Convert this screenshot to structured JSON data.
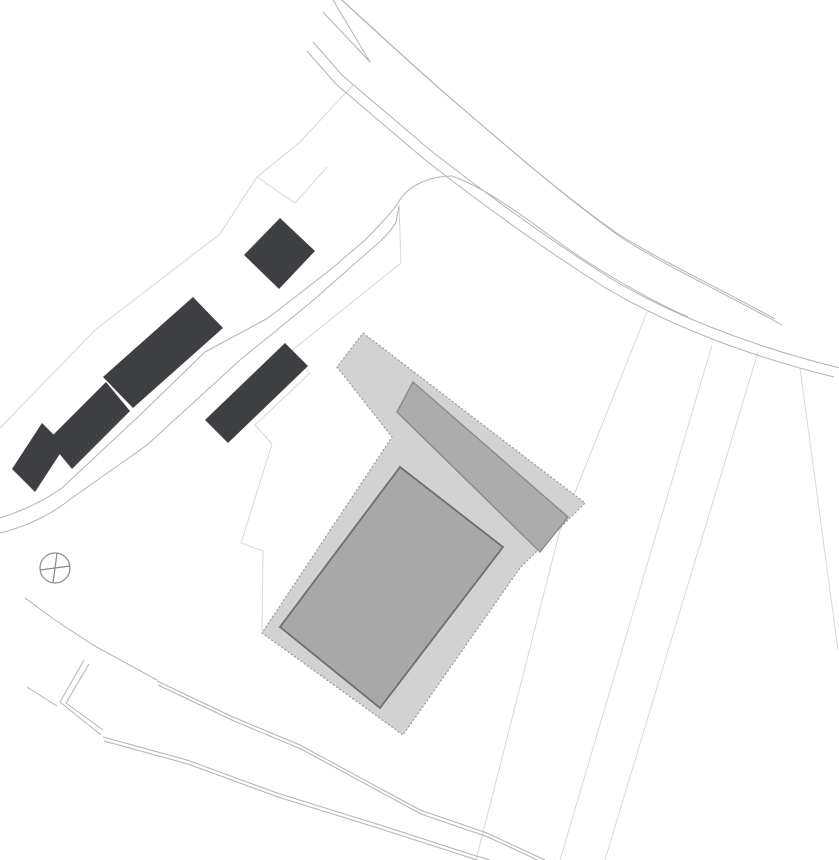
{
  "canvas": {
    "width": 839,
    "height": 860,
    "background": "#ffffff"
  },
  "palette": {
    "existing_building_fill": "#3d3f42",
    "platform_fill": "#d2d2d2",
    "platform_edge": "#9a9aa0",
    "wing_fill": "#acacac",
    "wing_edge": "#8a8a8a",
    "main_building_fill": "#a8a8a8",
    "main_building_edge": "#6f6f6f",
    "road_line": "#b3b3b8",
    "faint_line": "#d7d7db",
    "marker_line": "#8a8a8a"
  },
  "site": {
    "platform": {
      "name": "proposed-site-platform",
      "points": "363,333 585,503 520,568 403,735 262,633 392,437 337,367",
      "fill": "#d2d2d2",
      "stroke": "#9a9aa0",
      "stroke_width": 1.2,
      "dash": "2 2"
    },
    "wing": {
      "name": "proposed-building-wing",
      "points": "413,382 568,517 540,552 397,412",
      "fill": "#acacac",
      "stroke": "#8a8a8a",
      "stroke_width": 1.4
    },
    "main_building": {
      "name": "proposed-main-building",
      "points": "400,467 503,547 380,708 280,627",
      "fill": "#a8a8a8",
      "stroke": "#6f6f6f",
      "stroke_width": 1.8
    }
  },
  "existing_buildings": [
    {
      "name": "existing-building-north",
      "points": "244,255 280,218 315,251 279,289"
    },
    {
      "name": "existing-building-row-upper",
      "points": "193,297 223,328 133,408 103,377"
    },
    {
      "name": "existing-building-row-middle",
      "points": "106,382 130,411 72,469 48,440"
    },
    {
      "name": "existing-building-row-lower",
      "points": "42,423 65,446 35,492 12,469"
    },
    {
      "name": "existing-building-small-east",
      "points": "285,343 308,366 228,443 205,420"
    }
  ],
  "roads": [
    {
      "name": "main-road-north-edge",
      "d": "M342,0 C375,30 420,72 462,108 C520,158 575,205 625,240 C670,268 730,296 782,325",
      "dx": -7,
      "dy": -6
    },
    {
      "name": "main-road-south-edge",
      "d": "M313,42 L342,75 C365,95 395,120 430,150 C490,197 550,240 610,278 C670,314 750,346 840,368",
      "dx": -6,
      "dy": 9
    },
    {
      "name": "road-fork-island",
      "d": "M333,0 L370,62 L323,12",
      "dx": 0,
      "dy": 0
    },
    {
      "name": "street-northwest-edge",
      "d": "M0,518 C25,510 45,500 62,488 L140,415 L205,352 L268,318 L330,270 L365,240 Q390,215 398,203 Q405,190 420,183 Q435,176 452,176",
      "dx": 0,
      "dy": 0
    },
    {
      "name": "street-southeast-edge",
      "d": "M0,533 C28,526 52,514 72,498 L147,445 L240,360 L310,303 L368,252 Q390,234 396,222 L399,206",
      "dx": 0,
      "dy": 0
    },
    {
      "name": "junction-boundary-line",
      "d": "M452,176 C490,190 525,218 560,243 C600,272 650,300 688,317",
      "dx": 0,
      "dy": 0
    },
    {
      "name": "footpath-upper",
      "d": "M157,681 L233,717 L300,745 L420,810 L487,833 L545,860",
      "dx": 1,
      "dy": 4
    },
    {
      "name": "footpath-lower",
      "d": "M103,737 L187,760 L277,793 L380,825 L473,855 L490,860",
      "dx": 1,
      "dy": 4
    },
    {
      "name": "boundary-southwest",
      "d": "M25,598 L55,620 L93,645 L157,680",
      "dx": 0,
      "dy": 0
    },
    {
      "name": "boundary-spur",
      "d": "M27,687 L57,706",
      "dx": 0,
      "dy": 0
    },
    {
      "name": "retaining-wall-outer",
      "d": "M84,660 L60,702 L101,735",
      "dx": 0,
      "dy": 0
    },
    {
      "name": "retaining-wall-inner",
      "d": "M89,664 L66,703 L103,730",
      "dx": 0,
      "dy": 0
    }
  ],
  "parcel_lines": [
    {
      "name": "parcel-line-northwest-chain",
      "d": "M0,428 L95,330 L220,234 L257,177 L300,142 L353,85"
    },
    {
      "name": "parcel-line-north-notch",
      "d": "M257,177 L295,203 L327,167"
    },
    {
      "name": "parcel-line-west-staircase",
      "d": "M399,205 L401,263 L290,352 L310,373 L255,425 L272,444 L241,543 L263,551 L262,633"
    },
    {
      "name": "parcel-line-southeast-1",
      "d": "M647,312 L560,530 L476,860"
    },
    {
      "name": "parcel-line-southeast-2",
      "d": "M712,345 L560,860"
    },
    {
      "name": "parcel-line-southeast-3",
      "d": "M758,352 L605,860"
    },
    {
      "name": "parcel-line-east",
      "d": "M800,368 L838,650"
    }
  ],
  "marker": {
    "name": "survey-marker-icon",
    "cx": 55,
    "cy": 568,
    "r": 15,
    "cross1": "M40,570 L70,566",
    "cross2": "M57,553 L53,583"
  }
}
